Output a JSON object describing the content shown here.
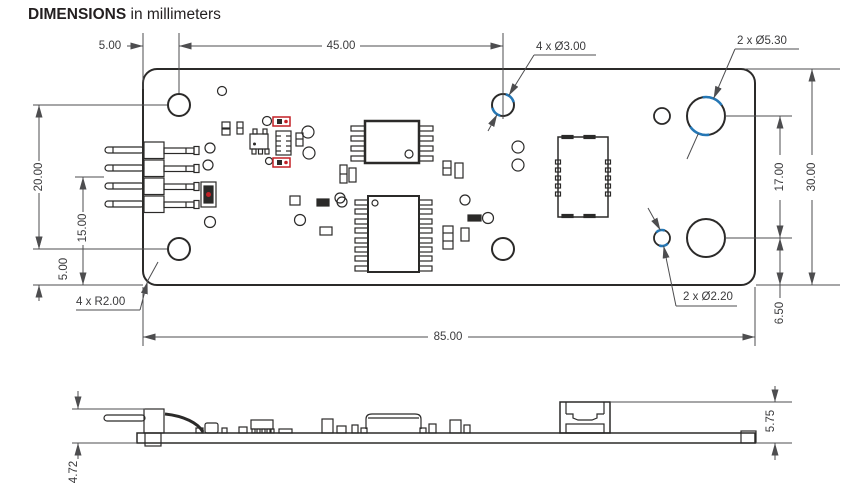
{
  "title": {
    "label": "DIMENSIONS",
    "suffix": " in millimeters"
  },
  "colors": {
    "line": "#2b2a29",
    "dimension": "#4d4d4f",
    "highlight_blue": "#2577b5",
    "component_red": "#c42127",
    "background": "#ffffff"
  },
  "top_view": {
    "dimensions": {
      "left_edge_to_hole": "5.00",
      "hole_span": "45.00",
      "upper_left_hole_span": "20.00",
      "header_to_bottom": "15.00",
      "lower_left_hole_offset": "5.00",
      "board_width": "85.00",
      "right_hole_span": "17.00",
      "board_height": "30.00",
      "right_hole_bottom_offset": "6.50"
    },
    "callouts": {
      "mounting_holes": "4 x Ø3.00",
      "large_holes": "2 x Ø5.30",
      "small_holes": "2 x Ø2.20",
      "corner_radius": "4 x R2.00"
    }
  },
  "side_view": {
    "dimensions": {
      "component_height": "5.75",
      "pin_protrusion": "4.72"
    }
  }
}
